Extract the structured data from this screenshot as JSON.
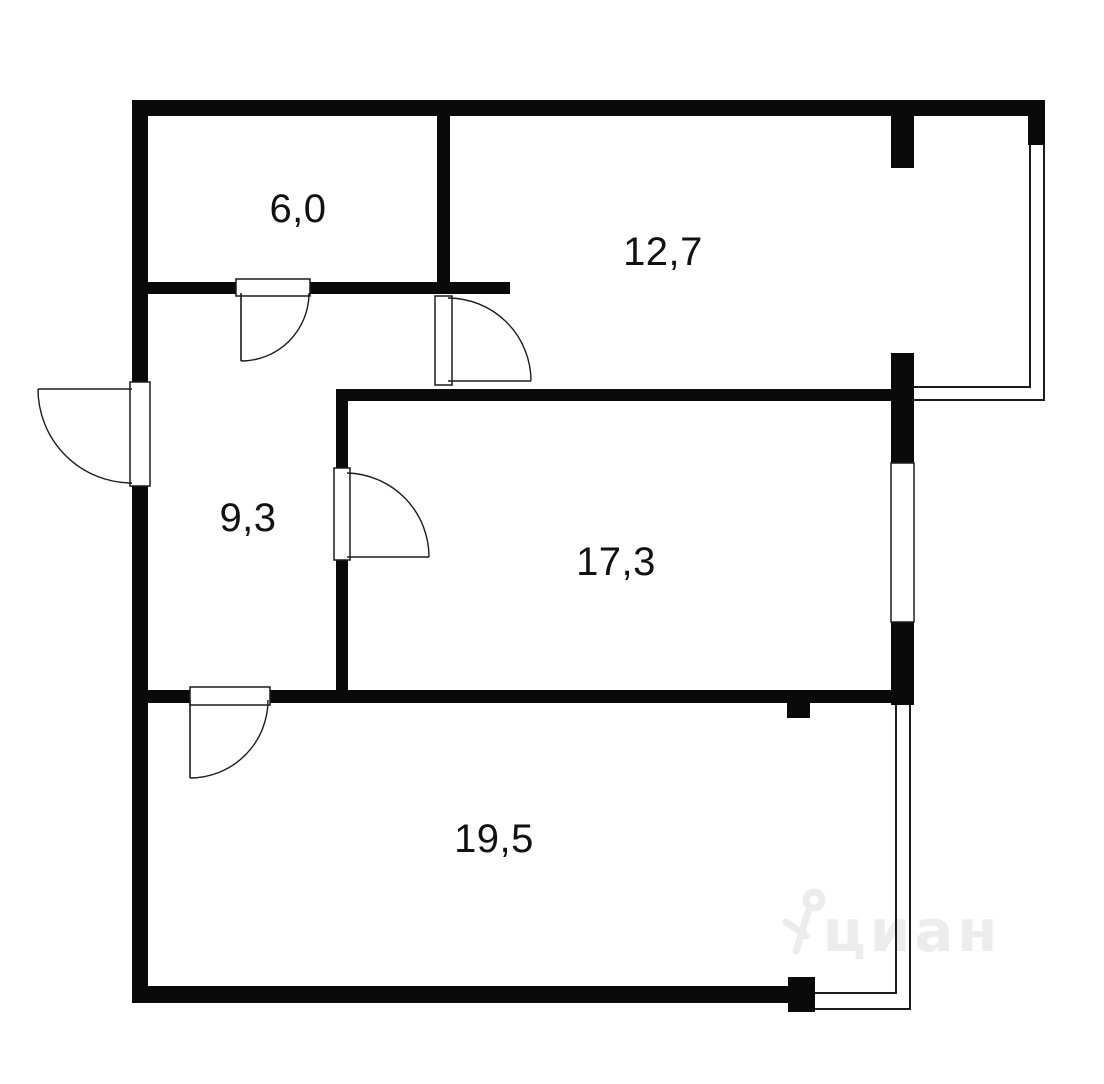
{
  "floor_plan": {
    "title": "apartment-floor-plan",
    "area_units": "m2",
    "rooms": [
      {
        "name": "room-top-left",
        "area_label": "6,0"
      },
      {
        "name": "room-top-right",
        "area_label": "12,7"
      },
      {
        "name": "hallway",
        "area_label": "9,3"
      },
      {
        "name": "room-middle",
        "area_label": "17,3"
      },
      {
        "name": "room-bottom",
        "area_label": "19,5"
      }
    ],
    "doors": [
      {
        "name": "entrance-door",
        "swing": "outward-left"
      },
      {
        "name": "door-room-6-0",
        "swing": "into-hallway"
      },
      {
        "name": "door-room-12-7",
        "swing": "into-room"
      },
      {
        "name": "door-room-17-3",
        "swing": "into-room"
      },
      {
        "name": "door-room-19-5",
        "swing": "into-room"
      }
    ],
    "windows": [
      {
        "name": "bay-glazing-top-right"
      },
      {
        "name": "window-room-17-3"
      },
      {
        "name": "bay-glazing-bottom-right"
      }
    ]
  },
  "watermark": {
    "text": "циан"
  },
  "colors": {
    "walls": "#0a0a0a",
    "background": "#ffffff",
    "line": "#1c1c1c",
    "watermark": "#ececec"
  }
}
